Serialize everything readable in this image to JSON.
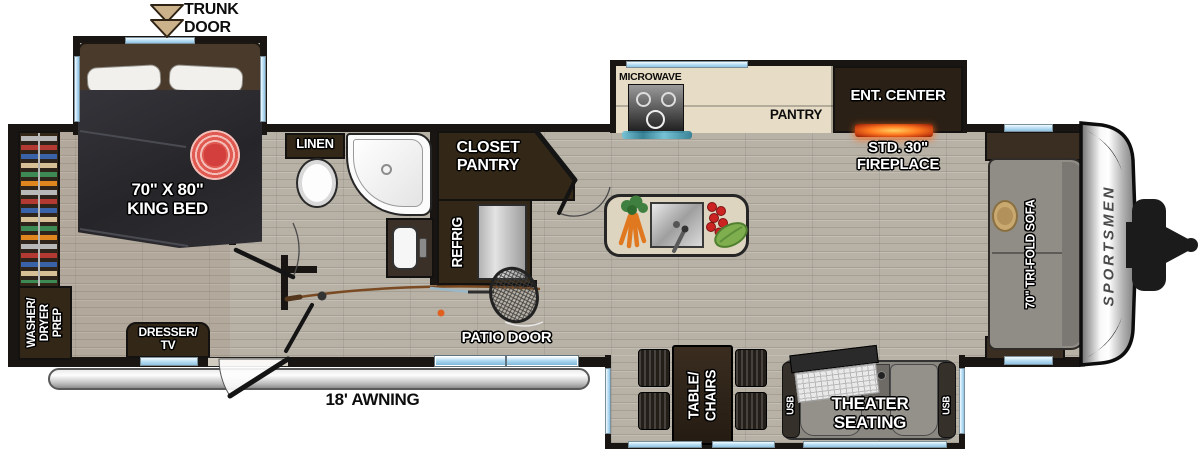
{
  "meta": {
    "brand": "SPORTSMEN"
  },
  "colors": {
    "wall": "#181512",
    "floor_wood": "#b7b1a6",
    "cabinet_dark_brown": "#332818",
    "counter_cream": "#e7ddc6",
    "window_blue": "#bfe2f5",
    "awning_silver": "#d9d9d9",
    "fireplace_orange": "#ff7a20",
    "rug_red": "#e05a52",
    "sofa_gray": "#908c86",
    "theater_gray": "#8a8680"
  },
  "callouts": {
    "trunk_door": "TRUNK\nDOOR",
    "awning": "18' AWNING",
    "patio_door": "PATIO DOOR"
  },
  "bedroom": {
    "king_bed": "70\" X 80\"\nKING BED",
    "washer_dryer": "WASHER/\nDRYER\nPREP",
    "dresser": "DRESSER/\nTV"
  },
  "bath": {
    "linen": "LINEN",
    "closet_pantry": "CLOSET\nPANTRY",
    "refrig": "REFRIG"
  },
  "kitchen": {
    "microwave": "MICROWAVE",
    "pantry": "PANTRY",
    "ent_center": "ENT. CENTER",
    "fireplace": "STD. 30\"\nFIREPLACE"
  },
  "living": {
    "sofa": "70\" TRI-FOLD SOFA",
    "theater": "THEATER\nSEATING",
    "usb_left": "USB",
    "usb_right": "USB",
    "table_chairs": "TABLE/\nCHAIRS"
  }
}
